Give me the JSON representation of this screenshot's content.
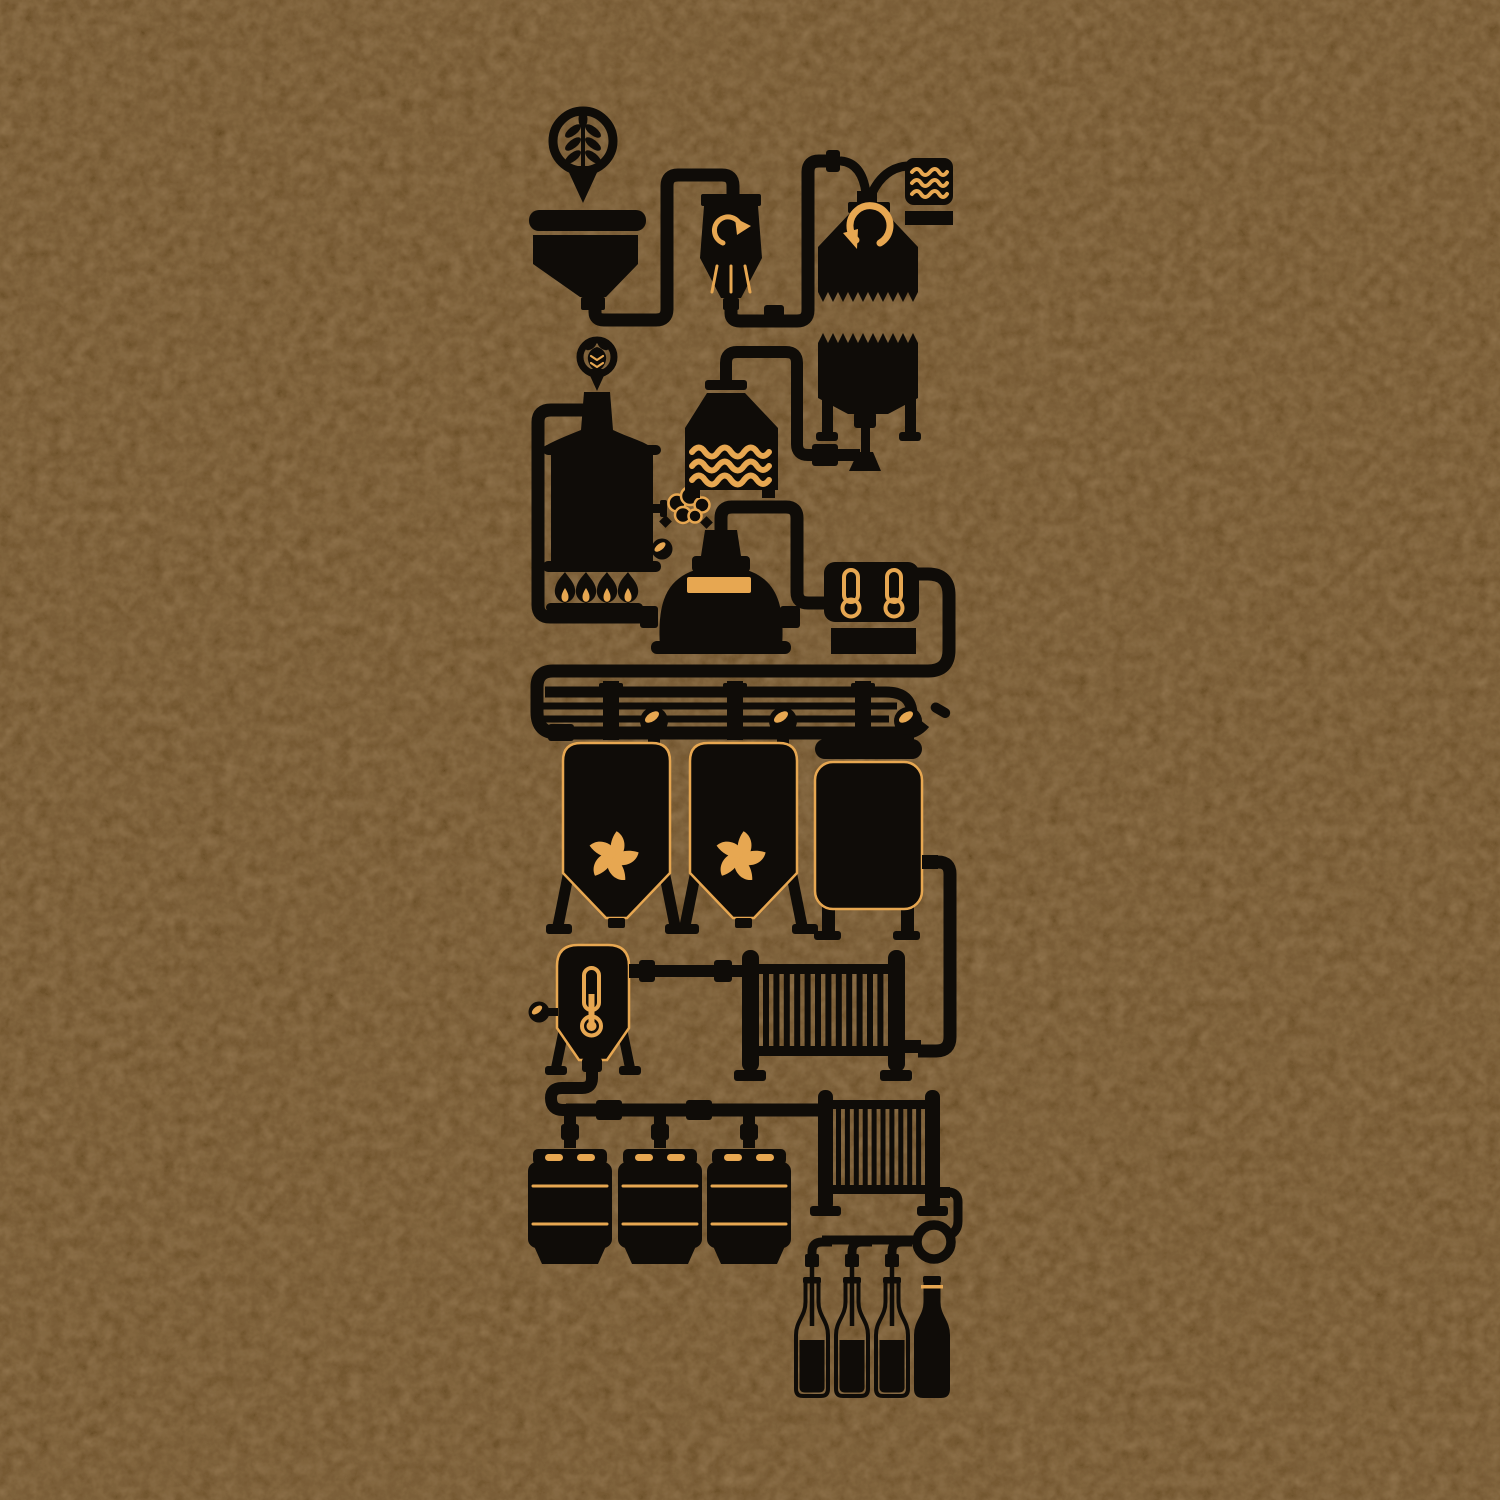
{
  "artwork": {
    "title": "Beer brewing process silhouette infographic on kraft background",
    "type": "illustration",
    "colors": {
      "bgc": "#e7a751",
      "ink": "#0f0c08"
    },
    "stages": [
      {
        "id": "grain-pin",
        "icon": "wheat-icon",
        "quantity": 1
      },
      {
        "id": "grain-hopper",
        "icon": "hopper-icon",
        "quantity": 1
      },
      {
        "id": "grain-mill",
        "icon": "mill-recirculation-arrow-icon",
        "quantity": 1
      },
      {
        "id": "mash-tun",
        "icon": "counterclockwise-arrow-icon",
        "quantity": 1
      },
      {
        "id": "hot-water-box",
        "icon": "water-waves-icon",
        "quantity": 1
      },
      {
        "id": "hop-pin",
        "icon": "hop-cone-icon",
        "quantity": 1
      },
      {
        "id": "boil-kettle",
        "icon": "kettle-burner-flames-icon",
        "quantity": 1
      },
      {
        "id": "steam-puff",
        "icon": "steam-cloud-icon",
        "quantity": 1
      },
      {
        "id": "pressure-gauges",
        "icon": "gauge-icon",
        "quantity": 3
      },
      {
        "id": "hot-liquor-tank",
        "icon": "tank-waves-icon",
        "quantity": 1
      },
      {
        "id": "grant-vessel",
        "icon": "jagged-tank-funnel-icon",
        "quantity": 1
      },
      {
        "id": "whirlpool-still",
        "icon": "dome-kettle-icon",
        "quantity": 1
      },
      {
        "id": "temperature-panel",
        "icon": "thermometer-icon",
        "quantity": 2
      },
      {
        "id": "distribution-manifold",
        "icon": "ball-valve-icon",
        "quantity": 3
      },
      {
        "id": "conical-fermenters",
        "icon": "cooling-fan-icon",
        "quantity": 2
      },
      {
        "id": "bright-tank",
        "icon": "cylindrical-tank-icon",
        "quantity": 1
      },
      {
        "id": "conditioning-tank",
        "icon": "thermometer-tank-icon",
        "quantity": 1
      },
      {
        "id": "heat-exchanger-large",
        "icon": "finned-radiator-icon",
        "quantity": 1
      },
      {
        "id": "kegs",
        "icon": "keg-icon",
        "quantity": 3
      },
      {
        "id": "bottling-cooler",
        "icon": "finned-radiator-icon",
        "quantity": 1
      },
      {
        "id": "filler-tubes",
        "icon": "filler-tube-icon",
        "quantity": 3
      },
      {
        "id": "bottles-filling",
        "icon": "bottle-outline-icon",
        "quantity": 3
      },
      {
        "id": "bottle-finished",
        "icon": "bottle-solid-icon",
        "quantity": 1
      }
    ]
  }
}
